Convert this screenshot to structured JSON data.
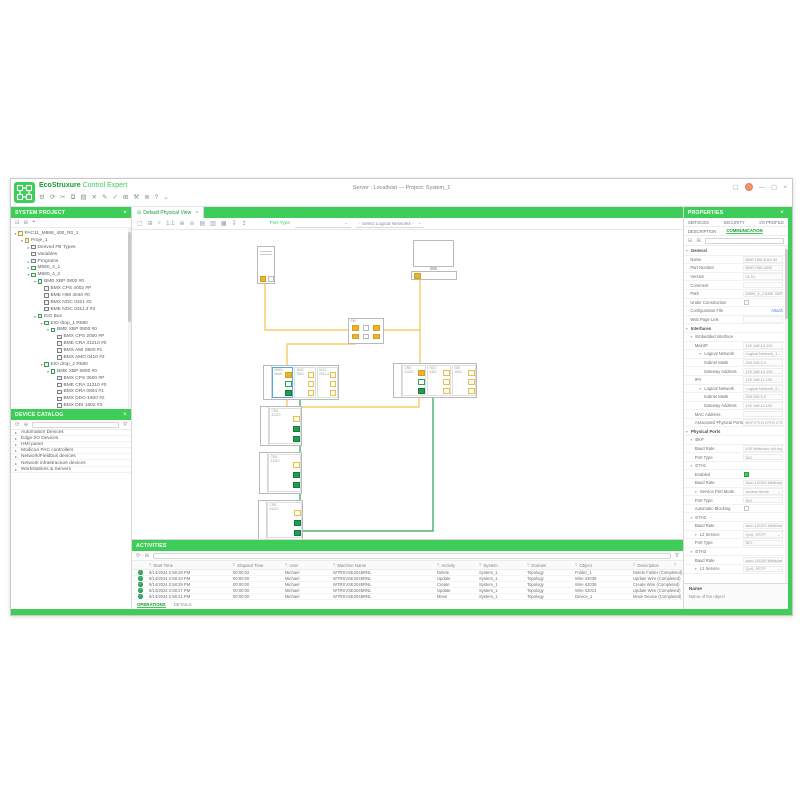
{
  "window": {
    "title": "Server : Localhost — Project: System_1",
    "brand_eco": "EcoStruxure",
    "brand_product": " Control Expert"
  },
  "main_toolbar": {
    "icons": [
      {
        "name": "settings-icon",
        "glyph": "⚙"
      },
      {
        "name": "sync-icon",
        "glyph": "⟳"
      },
      {
        "name": "cut-icon",
        "glyph": "✂"
      },
      {
        "name": "copy-icon",
        "glyph": "⧉"
      },
      {
        "name": "paste-icon",
        "glyph": "▤"
      },
      {
        "name": "delete-icon",
        "glyph": "✕"
      },
      {
        "name": "edit-icon",
        "glyph": "✎"
      },
      {
        "name": "validate-icon",
        "glyph": "✓"
      },
      {
        "name": "grid-icon",
        "glyph": "⊞"
      },
      {
        "name": "tools-icon",
        "glyph": "⚒"
      },
      {
        "name": "deploy-icon",
        "glyph": "⊕"
      },
      {
        "name": "help-icon",
        "glyph": "?"
      },
      {
        "name": "more-icon",
        "glyph": "⌄"
      }
    ]
  },
  "system_project": {
    "title": "SYSTEM PROJECT",
    "close_glyph": "×",
    "tree": [
      {
        "d": 0,
        "t": "PAC11_M868_400_R0_1",
        "e": "o",
        "ic": "f"
      },
      {
        "d": 1,
        "t": "Proje_1",
        "e": "o",
        "ic": "f"
      },
      {
        "d": 2,
        "t": "Derived FB Types",
        "e": "c",
        "ic": "m"
      },
      {
        "d": 2,
        "t": "Variables",
        "e": "",
        "ic": "m"
      },
      {
        "d": 2,
        "t": "Programs",
        "e": "c",
        "ic": "m"
      },
      {
        "d": 2,
        "t": "M580_4_1",
        "e": "c",
        "ic": "c"
      },
      {
        "d": 2,
        "t": "M580_4_2",
        "e": "o",
        "ic": "c"
      },
      {
        "d": 3,
        "t": "BME XBP 0800 #0",
        "e": "o",
        "ic": "c"
      },
      {
        "d": 4,
        "t": "BMX CPS 4002 #P",
        "e": "",
        "ic": "m"
      },
      {
        "d": 4,
        "t": "BME H58 4040 #0",
        "e": "",
        "ic": "m"
      },
      {
        "d": 4,
        "t": "BMX NOC 0321 #2",
        "e": "",
        "ic": "m"
      },
      {
        "d": 4,
        "t": "BME NOC 0311.4 #3",
        "e": "",
        "ic": "m"
      },
      {
        "d": 3,
        "t": "EIO Bus",
        "e": "o",
        "ic": "c"
      },
      {
        "d": 4,
        "t": "EIO drop_1 R580",
        "e": "o",
        "ic": "c"
      },
      {
        "d": 5,
        "t": "BME XBP 0800 #0",
        "e": "o",
        "ic": "c"
      },
      {
        "d": 6,
        "t": "BMX CPS 2000 #P",
        "e": "",
        "ic": "m"
      },
      {
        "d": 6,
        "t": "BME CRA 31210 #0",
        "e": "",
        "ic": "m"
      },
      {
        "d": 6,
        "t": "BMX AMI 0800 #1",
        "e": "",
        "ic": "m"
      },
      {
        "d": 6,
        "t": "BMX AMO 0410 #2",
        "e": "",
        "ic": "m"
      },
      {
        "d": 4,
        "t": "EIO drop_2 R580",
        "e": "o",
        "ic": "c"
      },
      {
        "d": 5,
        "t": "BME XBP 0800 #0",
        "e": "o",
        "ic": "c"
      },
      {
        "d": 6,
        "t": "BMX CPS 3500 #P",
        "e": "",
        "ic": "m"
      },
      {
        "d": 6,
        "t": "BME CRA 31210 #0",
        "e": "",
        "ic": "m"
      },
      {
        "d": 6,
        "t": "BMX DRA 0804 #1",
        "e": "",
        "ic": "m"
      },
      {
        "d": 6,
        "t": "BMX DDO 1600 #2",
        "e": "",
        "ic": "m"
      },
      {
        "d": 6,
        "t": "BMX DDI 1602 #3",
        "e": "",
        "ic": "m"
      },
      {
        "d": 5,
        "t": "BME XBP 0800 #1",
        "e": "o",
        "ic": "c"
      },
      {
        "d": 6,
        "t": "BMX CPS 3500 #P",
        "e": "",
        "ic": "m"
      },
      {
        "d": 6,
        "t": "BMX DRA 1605 #4",
        "e": "",
        "ic": "m"
      },
      {
        "d": 6,
        "t": "BMX EHC 0500 #5",
        "e": "",
        "ic": "m"
      },
      {
        "d": 6,
        "t": "BMX DDO 1600 #6",
        "e": "",
        "ic": "m"
      },
      {
        "d": 6,
        "t": "BMX EHC 0800 #7",
        "e": "",
        "ic": "m"
      },
      {
        "d": 4,
        "t": "EIO drop_3 R580",
        "e": "o",
        "ic": "c"
      },
      {
        "d": 5,
        "t": "BME XBP 0800 #0",
        "e": "o",
        "ic": "c"
      },
      {
        "d": 6,
        "t": "BMX CPS 3500 #P",
        "e": "",
        "ic": "m"
      },
      {
        "d": 6,
        "t": "BME CRA 31210 #0",
        "e": "",
        "ic": "m"
      },
      {
        "d": 6,
        "t": "BMX DRA 1605 #1",
        "e": "",
        "ic": "m"
      },
      {
        "d": 2,
        "t": "FFB_M12_2_1",
        "e": "",
        "ic": "m"
      },
      {
        "d": 2,
        "t": "ATV340_1",
        "e": "",
        "ic": "m"
      },
      {
        "d": 2,
        "t": "STB_NRD_1",
        "e": "",
        "ic": "m"
      },
      {
        "d": 2,
        "t": "ATV940_1",
        "e": "",
        "ic": "m"
      },
      {
        "d": 2,
        "t": "M820_TSC_NB_00_1",
        "e": "",
        "ic": "m"
      },
      {
        "d": 2,
        "t": "TeSysT_1",
        "e": "",
        "ic": "m"
      },
      {
        "d": 0,
        "t": "Workstation_1",
        "e": "o",
        "ic": "c"
      },
      {
        "d": 1,
        "t": "PC_1",
        "e": "",
        "ic": "m"
      },
      {
        "d": 0,
        "t": "Routing_Switch_1",
        "e": "",
        "ic": "c"
      }
    ]
  },
  "device_catalog": {
    "title": "DEVICE CATALOG",
    "close_glyph": "×",
    "items": [
      "Automation Devices",
      "Edge I/O Devices",
      "HMI panel",
      "Modicon PAC controllers",
      "Network/Fieldbus devices",
      "Network infrastructure devices",
      "Workstations & Servers"
    ]
  },
  "canvas_view": {
    "tab_label": "Default Physical View",
    "tab_close_glyph": "×",
    "toolbar_icons": [
      {
        "name": "select-tool-icon",
        "glyph": "▢"
      },
      {
        "name": "fit-view-icon",
        "glyph": "⊞"
      },
      {
        "name": "zoom-tool-icon",
        "glyph": "⌕"
      },
      {
        "name": "zoom-100-icon",
        "glyph": "1:1"
      },
      {
        "name": "zoom-in-icon",
        "glyph": "⊕"
      },
      {
        "name": "zoom-out-icon",
        "glyph": "⊖"
      },
      {
        "name": "export-icon",
        "glyph": "▤"
      },
      {
        "name": "snapshot-icon",
        "glyph": "▥"
      },
      {
        "name": "layers-icon",
        "glyph": "▦"
      },
      {
        "name": "import-wires-icon",
        "glyph": "↧"
      },
      {
        "name": "export-wires-icon",
        "glyph": "↥"
      }
    ],
    "port_type_label": "Port Type",
    "network_filter_value": "- Select Logical Networks -"
  },
  "topology": {
    "devices": [
      {
        "type": "tower",
        "x": 125,
        "y": 16,
        "w": 18,
        "h": 38,
        "ports": [
          "y",
          "w"
        ]
      },
      {
        "type": "monitor",
        "x": 279,
        "y": 8,
        "w": 46,
        "h": 44
      },
      {
        "type": "switch",
        "label": "SW",
        "x": 216,
        "y": 88,
        "w": 36,
        "h": 26,
        "ports": [
          [
            "y",
            "w",
            "y"
          ],
          [
            "y",
            "w",
            "y"
          ]
        ]
      },
      {
        "type": "rack",
        "x": 131,
        "y": 135,
        "w": 76,
        "h": 35,
        "modules": [
          {
            "label": "M580\nMAIN",
            "sel": true,
            "ports": [
              "y",
              "gw",
              "g"
            ]
          },
          {
            "label": "NOC\n0321",
            "ports": [
              "yo",
              "yo",
              "yo"
            ]
          },
          {
            "label": "NOC\n0311-4",
            "ports": [
              "yo",
              "yo",
              "yo"
            ]
          }
        ]
      },
      {
        "type": "rack",
        "x": 261,
        "y": 133,
        "w": 84,
        "h": 35,
        "modules": [
          {
            "label": "CRA\n31210",
            "ports": [
              "y",
              "gw",
              "g"
            ]
          },
          {
            "label": "NOC\n0321",
            "ports": [
              "yo",
              "yo",
              "yo"
            ]
          },
          {
            "label": "DDI\n1602",
            "ports": [
              "yo",
              "yo",
              "yo"
            ]
          }
        ]
      },
      {
        "type": "drop",
        "x": 128,
        "y": 176,
        "w": 42,
        "h": 40,
        "modules": [
          {
            "label": "CRA\n31210",
            "ports": [
              "yo",
              "g",
              "g"
            ]
          }
        ]
      },
      {
        "type": "drop",
        "x": 127,
        "y": 222,
        "w": 43,
        "h": 42,
        "modules": [
          {
            "label": "CRA\n31210",
            "ports": [
              "yo",
              "g",
              "g"
            ]
          }
        ]
      },
      {
        "type": "drop",
        "x": 126,
        "y": 270,
        "w": 45,
        "h": 40,
        "modules": [
          {
            "label": "CRA\n31210",
            "ports": [
              "yo",
              "g",
              "g"
            ]
          }
        ]
      }
    ],
    "wires": [
      {
        "c": "#f6c14b",
        "pts": [
          [
            133,
            54
          ],
          [
            133,
            100
          ],
          [
            216,
            100
          ]
        ]
      },
      {
        "c": "#f6c14b",
        "pts": [
          [
            288,
            50
          ],
          [
            288,
            140
          ]
        ]
      },
      {
        "c": "#f6c14b",
        "pts": [
          [
            252,
            100
          ],
          [
            288,
            100
          ]
        ]
      },
      {
        "c": "#f6c14b",
        "pts": [
          [
            224,
            114
          ],
          [
            155,
            114
          ],
          [
            155,
            140
          ]
        ]
      },
      {
        "c": "#f6c14b",
        "pts": [
          [
            155,
            170
          ],
          [
            155,
            177
          ],
          [
            287,
            177
          ],
          [
            287,
            168
          ]
        ]
      },
      {
        "c": "#2aa05a",
        "pts": [
          [
            157,
            163
          ],
          [
            168,
            163
          ],
          [
            168,
            192
          ],
          [
            160,
            192
          ]
        ]
      },
      {
        "c": "#2aa05a",
        "pts": [
          [
            160,
            204
          ],
          [
            168,
            204
          ],
          [
            168,
            237
          ],
          [
            160,
            237
          ]
        ]
      },
      {
        "c": "#2aa05a",
        "pts": [
          [
            160,
            249
          ],
          [
            168,
            249
          ],
          [
            168,
            284
          ],
          [
            160,
            284
          ]
        ]
      },
      {
        "c": "#2aa05a",
        "pts": [
          [
            290,
            163
          ],
          [
            301,
            163
          ],
          [
            301,
            301
          ],
          [
            166,
            301
          ],
          [
            166,
            296
          ]
        ]
      }
    ]
  },
  "activities": {
    "title": "ACTIVITIES",
    "columns": [
      "Start Time",
      "Elapsed Time",
      "User",
      "Machine Name",
      "Activity",
      "System",
      "Domain",
      "Object",
      "Description"
    ],
    "rows": [
      [
        "8/14/2024 2:58:29 PM",
        "00:00:02",
        "Michael",
        "WTRSVSE2045RNL",
        "Delete",
        "System_1",
        "Topology",
        "Folder_1",
        "Delete Folder (Completed)"
      ],
      [
        "8/14/2024 2:58:33 PM",
        "00:00:00",
        "Michael",
        "WTRSVSE2045RNL",
        "Update",
        "System_1",
        "Topology",
        "Wire 42039",
        "Update Wire (Completed)"
      ],
      [
        "8/14/2024 2:58:29 PM",
        "00:00:00",
        "Michael",
        "WTRSVSE2045RNL",
        "Create",
        "System_1",
        "Topology",
        "Wire 42038",
        "Create Wire (Completed)"
      ],
      [
        "8/14/2024 2:58:27 PM",
        "00:00:00",
        "Michael",
        "WTRSVSE2045RNL",
        "Update",
        "System_1",
        "Topology",
        "Wire 42014",
        "Update Wire (Completed)"
      ],
      [
        "8/14/2024 2:58:21 PM",
        "00:00:00",
        "Michael",
        "WTRSVSE2045RNL",
        "Move",
        "System_1",
        "Topology",
        "Device_1",
        "Move Device (Completed)"
      ]
    ],
    "tabs": [
      "OPERATIONS",
      "DETAILS"
    ],
    "active_tab": "OPERATIONS"
  },
  "properties": {
    "title": "PROPERTIES",
    "close_glyph": "×",
    "tabs_top": [
      "SERVICES",
      "SECURITY",
      "I/O PROFILE"
    ],
    "tabs_sub": [
      "DESCRIPTION",
      "COMMUNICATION"
    ],
    "active_sub_tab": "COMMUNICATION",
    "rows": [
      {
        "k": "grp",
        "d": 0,
        "l": "General"
      },
      {
        "k": "fld",
        "d": 1,
        "l": "Name",
        "v": "BME H58 4040 #0"
      },
      {
        "k": "fld",
        "d": 1,
        "l": "Part Number",
        "v": "BME-H58-4040"
      },
      {
        "k": "fld",
        "d": 1,
        "l": "Version",
        "v": "01.01"
      },
      {
        "k": "fld",
        "d": 1,
        "l": "Comment",
        "v": ""
      },
      {
        "k": "fld",
        "d": 1,
        "l": "Path",
        "v": "M580_4_2.BME XBP 0800"
      },
      {
        "k": "chk",
        "d": 1,
        "l": "Under Construction",
        "v": ""
      },
      {
        "k": "lnk",
        "d": 1,
        "l": "Configuration File",
        "v": "Attach"
      },
      {
        "k": "fld",
        "d": 1,
        "l": "Web Page Link",
        "v": ""
      },
      {
        "k": "grp",
        "d": 0,
        "l": "Interfaces"
      },
      {
        "k": "grp2",
        "d": 1,
        "l": "Embedded Interface"
      },
      {
        "k": "fld",
        "d": 2,
        "l": "MainIP",
        "v": "192.168.10.100"
      },
      {
        "k": "sel",
        "d": 3,
        "l": "Logical Network",
        "v": "Logical Network_1"
      },
      {
        "k": "fld",
        "d": 4,
        "l": "Subnet Mask",
        "v": "255.255.0.0"
      },
      {
        "k": "fld",
        "d": 4,
        "l": "Gateway Address",
        "v": "192.168.10.100"
      },
      {
        "k": "fld",
        "d": 2,
        "l": "IPA",
        "v": "192.168.11.100"
      },
      {
        "k": "sel",
        "d": 3,
        "l": "Logical Network",
        "v": "Logical Network_2"
      },
      {
        "k": "fld",
        "d": 4,
        "l": "Subnet Mask",
        "v": "255.255.0.0"
      },
      {
        "k": "fld",
        "d": 4,
        "l": "Gateway Address",
        "v": "192.168.11.100"
      },
      {
        "k": "fld",
        "d": 2,
        "l": "MAC Address",
        "v": ""
      },
      {
        "k": "fld",
        "d": 2,
        "l": "Associated Physical Ports",
        "v": "BKP ETH1 ETH2 ETH3"
      },
      {
        "k": "grp",
        "d": 0,
        "l": "Physical Ports"
      },
      {
        "k": "grp2",
        "d": 1,
        "l": "BKP"
      },
      {
        "k": "fld",
        "d": 2,
        "l": "Baud Rate",
        "v": "100 Mbits/sec full duplex"
      },
      {
        "k": "fld",
        "d": 2,
        "l": "Port Type",
        "v": "SIO"
      },
      {
        "k": "grp2",
        "d": 1,
        "l": "ETH1"
      },
      {
        "k": "chkg",
        "d": 2,
        "l": "Enabled",
        "v": ""
      },
      {
        "k": "fld",
        "d": 2,
        "l": "Baud Rate",
        "v": "Auto 10/100 Mbits/sec"
      },
      {
        "k": "sel",
        "d": 2,
        "l": "Service Port Mode",
        "v": "Access Mode"
      },
      {
        "k": "fld",
        "d": 2,
        "l": "Port Type",
        "v": "SIO"
      },
      {
        "k": "chk",
        "d": 2,
        "l": "Automatic Blocking",
        "v": ""
      },
      {
        "k": "grp2",
        "d": 1,
        "l": "ETH2"
      },
      {
        "k": "fld",
        "d": 2,
        "l": "Baud Rate",
        "v": "Auto 10/100 Mbits/sec"
      },
      {
        "k": "sel",
        "d": 2,
        "l": "L2 Service",
        "v": "QoS, RSTP"
      },
      {
        "k": "fld",
        "d": 2,
        "l": "Port Type",
        "v": "NIO"
      },
      {
        "k": "grp2",
        "d": 1,
        "l": "ETH3"
      },
      {
        "k": "fld",
        "d": 2,
        "l": "Baud Rate",
        "v": "Auto 10/100 Mbits/sec"
      },
      {
        "k": "sel",
        "d": 2,
        "l": "L2 Service",
        "v": "QoS, RSTP"
      }
    ],
    "help": {
      "title": "Name",
      "text": "Name of the object"
    }
  }
}
